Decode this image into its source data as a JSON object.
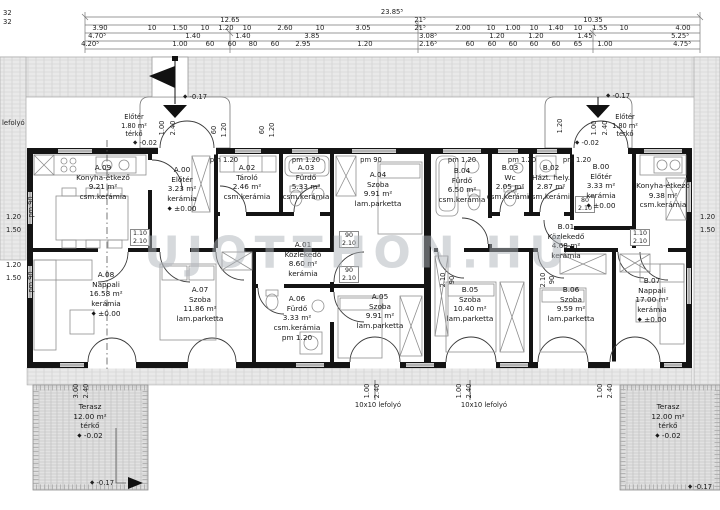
{
  "watermark": "UJOTTHON.HU",
  "icons": {
    "level_marker": "◆",
    "flag": "⚑",
    "spot_triangle": "▼",
    "arrow_right": "▶"
  },
  "dims": {
    "wall": "32",
    "row1_total": "23.85⁵",
    "row2": [
      "12.65",
      "21⁵",
      "10.35"
    ],
    "row3": [
      "3.90",
      "10",
      "1.50",
      "10",
      "1.20",
      "10",
      "2.60",
      "10",
      "3.05",
      "21⁵",
      "2.00",
      "10",
      "1.00",
      "10",
      "1.40",
      "10",
      "1.55",
      "10",
      "4.00"
    ],
    "row4": [
      "4.70⁵",
      "1.40",
      "1.40",
      "3.85",
      "3.08⁵",
      "1.20",
      "1.20",
      "1.45",
      "5.25⁵"
    ],
    "row5": [
      "4.20⁵",
      "1.00",
      "60",
      "60",
      "80",
      "60",
      "2.95",
      "1.20",
      "2.16⁵",
      "60",
      "60",
      "60",
      "60",
      "60",
      "65",
      "1.00",
      "4.75⁵"
    ]
  },
  "open_dims": {
    "d60": "60",
    "d80": "80",
    "d90": "90",
    "d100": "1.00",
    "d110": "1.10",
    "d120": "1.20",
    "d150": "1.50",
    "d210": "2.10",
    "d240": "2.40",
    "d300": "3.00"
  },
  "parapets": {
    "p90": "pm 90",
    "p120": "pm 1.20"
  },
  "drains": {
    "side": "lefolyó",
    "floor": "10x10 lefolyó"
  },
  "levels": {
    "street": "-0.17",
    "zero": "±0.00",
    "paving": "-0.02"
  },
  "entry_porch": {
    "name": "Előtér",
    "area": "1.80 m²",
    "surface": "térkő",
    "level": "-0.02"
  },
  "terrace": {
    "name": "Terasz",
    "area": "12.00 m²",
    "surface": "térkő",
    "level": "-0.02"
  },
  "rooms": [
    {
      "id": "A.09",
      "name": "Konyha-étkező",
      "area": "9.21 m²",
      "floor": "csm.kerámia"
    },
    {
      "id": "A.00",
      "name": "Előtér",
      "area": "3.23 m²",
      "floor": "kerámia",
      "level": "±0.00"
    },
    {
      "id": "A.02",
      "name": "Tároló",
      "area": "2.46 m²",
      "floor": "csm.kerámia"
    },
    {
      "id": "A.03",
      "name": "Fürdő",
      "area": "5.33 m²",
      "floor": "csm.kerámia"
    },
    {
      "id": "A.04",
      "name": "Szoba",
      "area": "9.91 m²",
      "floor": "lam.parketta"
    },
    {
      "id": "A.01",
      "name": "Közlekedő",
      "area": "8.60 m²",
      "floor": "kerámia"
    },
    {
      "id": "A.06",
      "name": "Fürdő",
      "area": "3.33 m²",
      "floor": "csm.kerámia"
    },
    {
      "id": "A.05",
      "name": "Szoba",
      "area": "9.91 m²",
      "floor": "lam.parketta"
    },
    {
      "id": "A.07",
      "name": "Szoba",
      "area": "11.86 m²",
      "floor": "lam.parketta"
    },
    {
      "id": "A.08",
      "name": "Nappali",
      "area": "16.58 m²",
      "floor": "kerámia",
      "level": "±0.00"
    },
    {
      "id": "B.04",
      "name": "Fürdő",
      "area": "6.50 m²",
      "floor": "csm.kerámia"
    },
    {
      "id": "B.03",
      "name": "Wc",
      "area": "2.05 m²",
      "floor": "csm.kerámia"
    },
    {
      "id": "B.02",
      "name": "Házt. hely.",
      "area": "2.87 m²",
      "floor": "csm.kerámia"
    },
    {
      "id": "B.01",
      "name": "Közlekedő",
      "area": "4.68 m²",
      "floor": "kerámia"
    },
    {
      "id": "B.00",
      "name": "Előtér",
      "area": "3.33 m²",
      "floor": "kerámia",
      "level": "±0.00"
    },
    {
      "id": "",
      "name": "Konyha-étkező",
      "area": "9.38 m²",
      "floor": "csm.kerámia"
    },
    {
      "id": "B.05",
      "name": "Szoba",
      "area": "10.40 m²",
      "floor": "lam.parketta"
    },
    {
      "id": "B.06",
      "name": "Szoba",
      "area": "9.59 m²",
      "floor": "lam.parketta"
    },
    {
      "id": "B.07",
      "name": "Nappali",
      "area": "17.00 m²",
      "floor": "kerámia",
      "level": "±0.00"
    }
  ]
}
